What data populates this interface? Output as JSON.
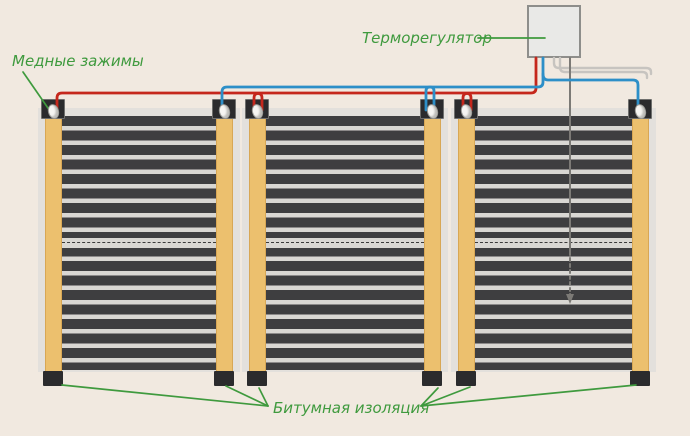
{
  "labels": {
    "copper_clamps": "Медные зажимы",
    "thermostat": "Терморегулятор",
    "bitumen_insulation": "Битумная изоляция"
  },
  "colors": {
    "bg": "#f1e9e0",
    "panel_edge": "#e3e0dc",
    "bar": "#ecc06e",
    "bar_edge": "#d8a755",
    "stripe_dark": "#3e3e40",
    "stripe_light": "#d9d7d3",
    "clamp": "#2b2b2d",
    "rivet": "#f6f5f2",
    "wire_red": "#c5271c",
    "wire_blue": "#2d8fc8",
    "cable_gray": "#c7c4c0",
    "sensor_gray": "#7c7a76",
    "box_fill": "#e9e9e7",
    "box_border": "#8e8e8b",
    "green": "#3f9a3e"
  }
}
